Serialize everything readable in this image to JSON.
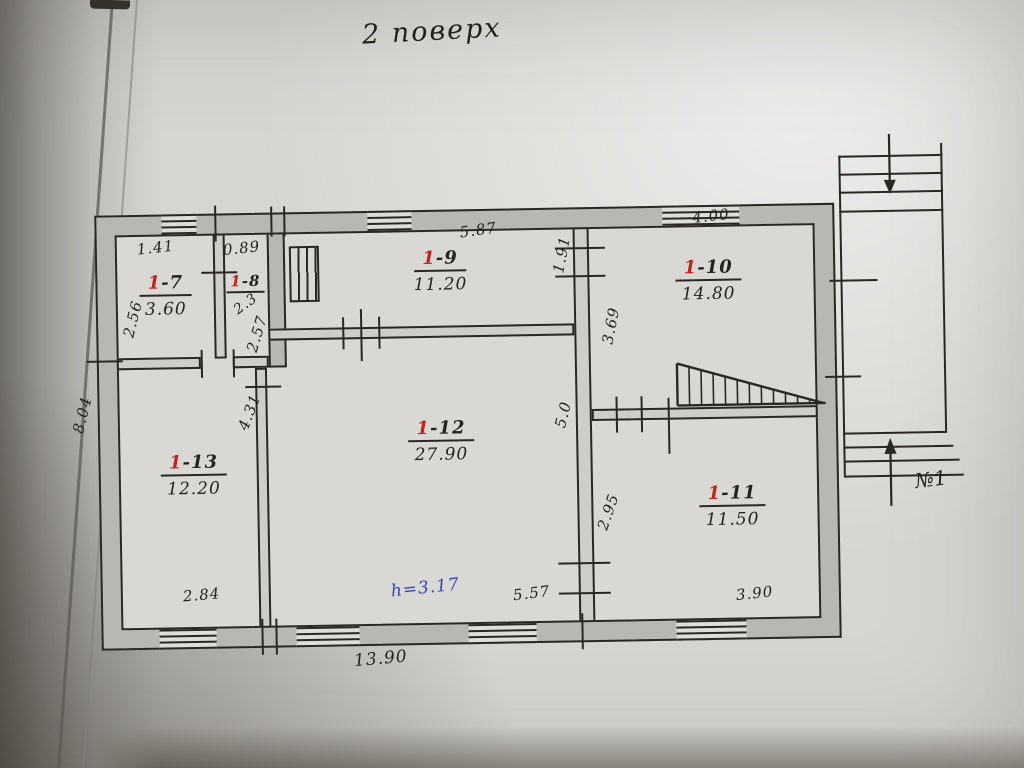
{
  "title": "2 поверх",
  "rooms": [
    {
      "name": "1-7",
      "num_red": "1",
      "num_suffix": "-7",
      "area": "3.60"
    },
    {
      "name": "1-8",
      "num_red": "1",
      "num_suffix": "-8",
      "area": "2.3"
    },
    {
      "name": "1-9",
      "num_red": "1",
      "num_suffix": "-9",
      "area": "11.20"
    },
    {
      "name": "1-10",
      "num_red": "1",
      "num_suffix": "-10",
      "area": "14.80"
    },
    {
      "name": "1-11",
      "num_red": "1",
      "num_suffix": "-11",
      "area": "11.50"
    },
    {
      "name": "1-12",
      "num_red": "1",
      "num_suffix": "-12",
      "area": "27.90"
    },
    {
      "name": "1-13",
      "num_red": "1",
      "num_suffix": "-13",
      "area": "12.20"
    }
  ],
  "dimensions": {
    "top_room7": "1.41",
    "top_room8": "0.89",
    "top_room9": "5.87",
    "corridor_top": "1.91",
    "top_room10": "4.00",
    "left_room7": "2.56",
    "right_room8": "2.57",
    "left_room10": "3.69",
    "right_room13": "4.31",
    "corridor_mid": "5.0",
    "left_room11": "2.95",
    "outer_left": "8.04",
    "bottom_room13": "2.84",
    "bottom_room12": "5.57",
    "bottom_room11": "3.90",
    "outer_bottom": "13.90"
  },
  "annotations": {
    "ceiling_height": "h=3.17",
    "stair_number": "№1"
  },
  "colors": {
    "ink": "#26231f",
    "room_number_red": "#c2231b",
    "height_note_blue": "#2f49b5",
    "wall_shade": "#b9b7b2",
    "paper": "#d6d5d1"
  }
}
